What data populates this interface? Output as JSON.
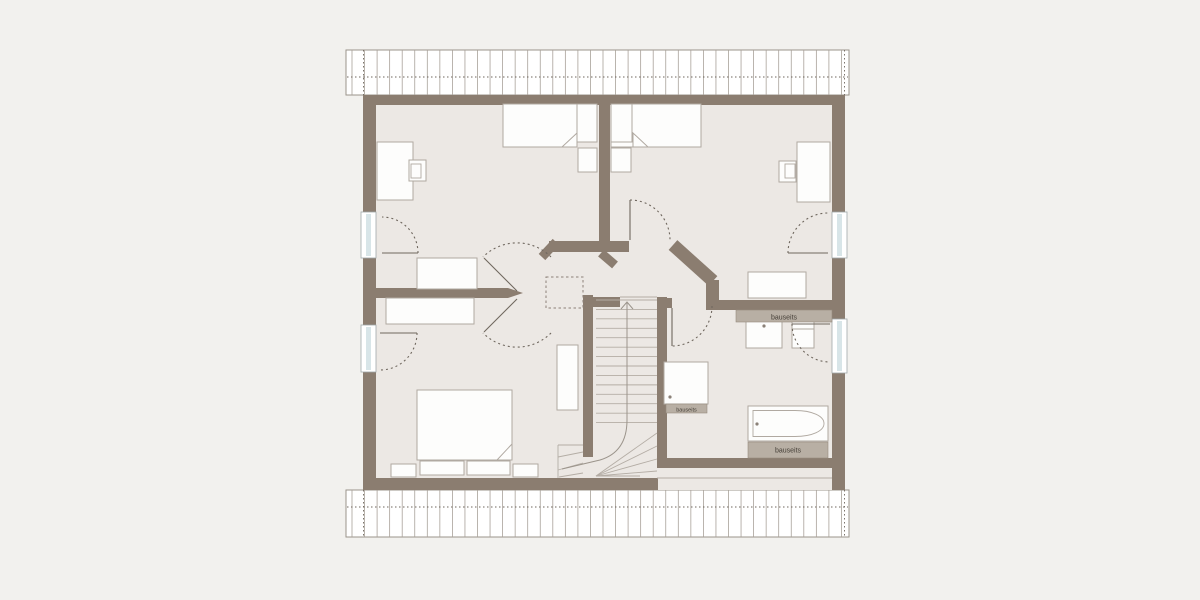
{
  "floor_plan": {
    "annotations": {
      "vanity_label": "bauseits",
      "shower_label": "bauseits",
      "bathtub_label": "bauseits"
    },
    "colors": {
      "background": "#f2f1ee",
      "floor": "#ece8e4",
      "wall": "#8b7d70",
      "furniture_fill": "#fdfdfc",
      "window_glass": "#d8e5e8",
      "label_strip": "#b8afa4",
      "label_text": "#453f37",
      "line": "#6f675e"
    }
  }
}
